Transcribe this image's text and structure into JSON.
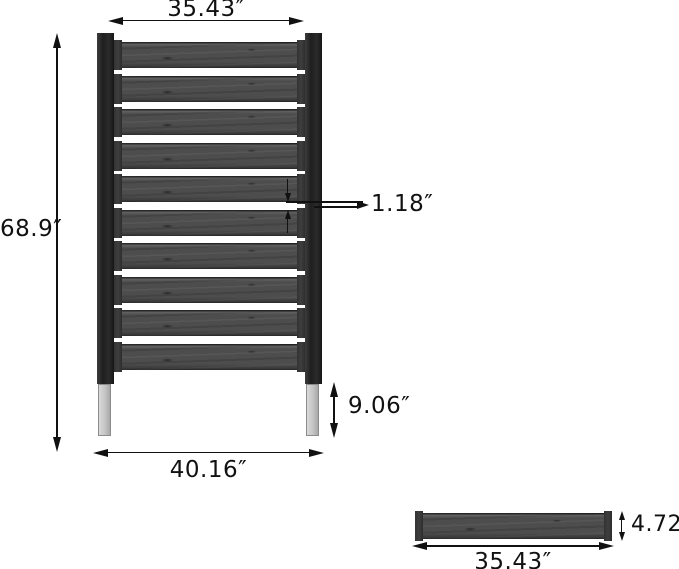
{
  "diagram": {
    "kind": "product-dimension-drawing",
    "subject": "slatted privacy fence panel with legs"
  },
  "front_view": {
    "slat_count": 10,
    "gap_count": 9,
    "dim_width_top": "35.43″",
    "dim_height_overall": "68.9″",
    "dim_slat_gap": "1.18″",
    "dim_leg_height": "9.06″",
    "dim_width_base": "40.16″"
  },
  "slat_view": {
    "dim_thickness": "4.72″",
    "dim_length": "35.43″"
  },
  "colors": {
    "wood_slat": "#4d4d4d",
    "post": "#222222",
    "leg": "#c9c9c9",
    "line": "#111111",
    "background": "#ffffff"
  }
}
